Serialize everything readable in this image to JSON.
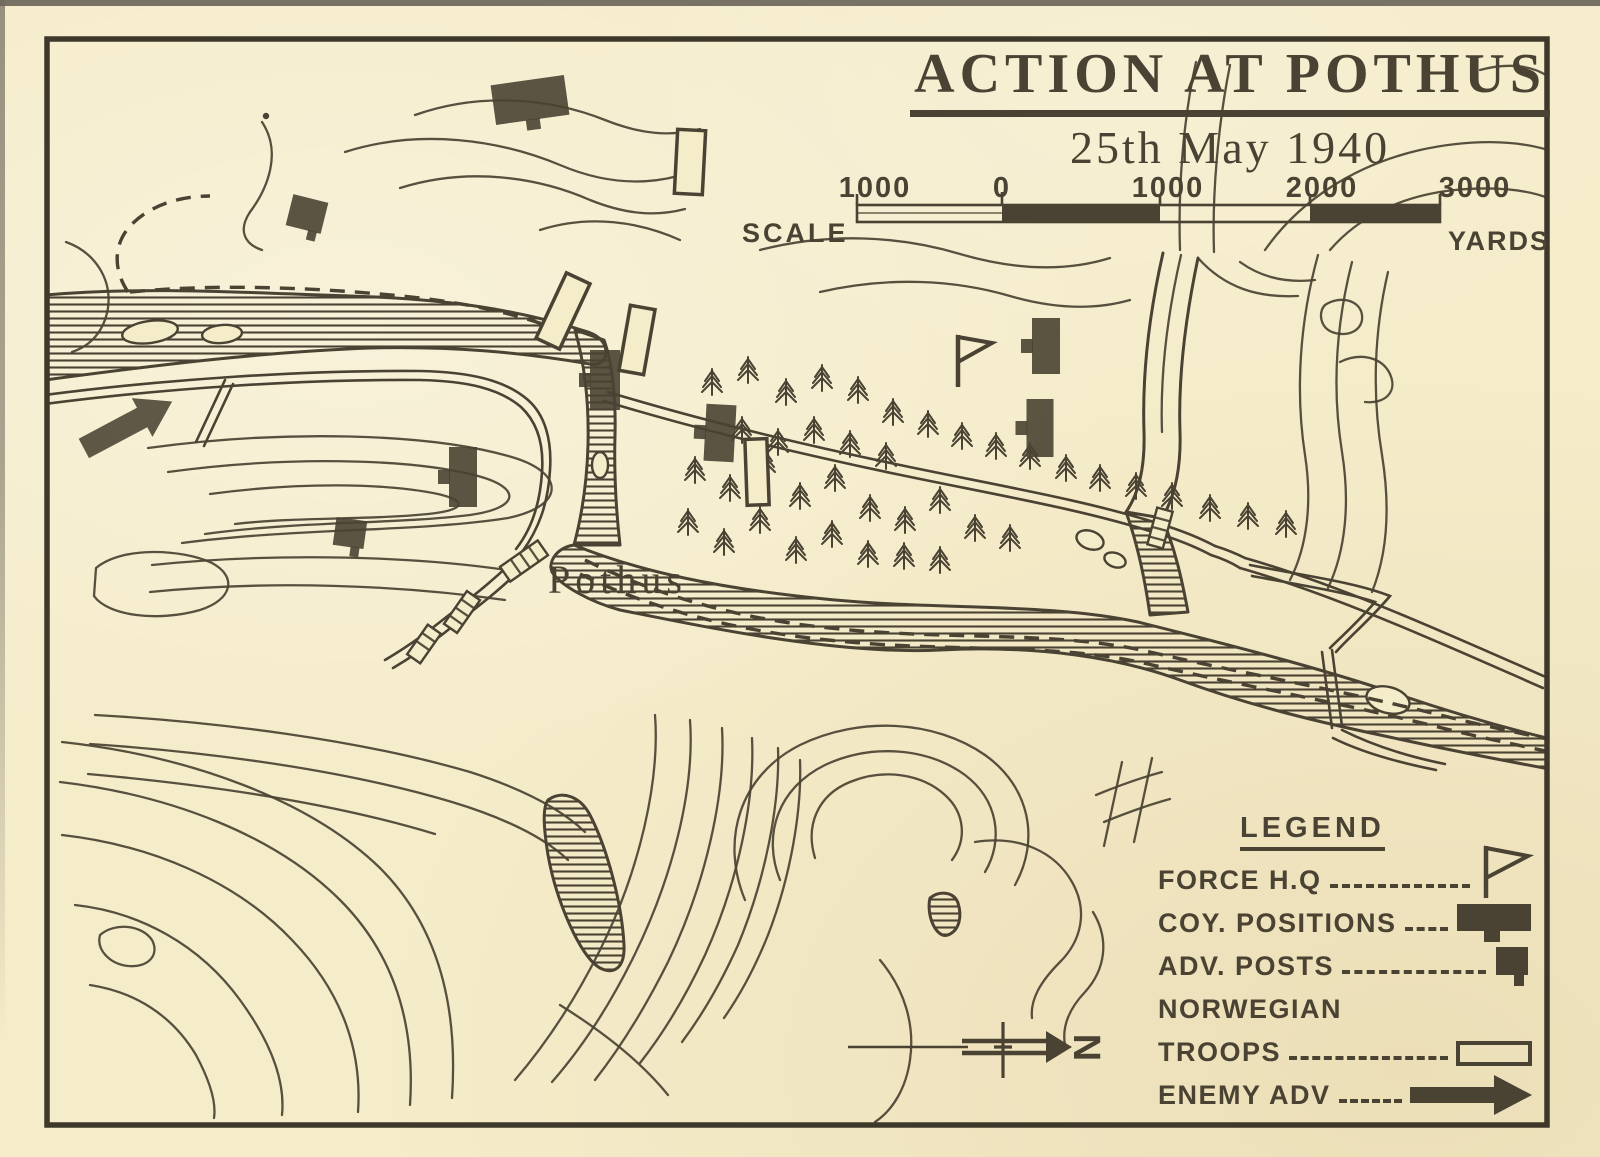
{
  "page": {
    "title": "ACTION AT POTHUS",
    "date": "25th May 1940"
  },
  "scale_bar": {
    "label": "SCALE",
    "unit": "YARDS",
    "tick_labels": [
      "1000",
      "0",
      "1000",
      "2000",
      "3000"
    ]
  },
  "map": {
    "place_label": "Pothus",
    "compass_label": "N"
  },
  "legend": {
    "heading": "LEGEND",
    "items": [
      {
        "label": "FORCE  H.Q",
        "symbol": "force-hq-flag"
      },
      {
        "label": "COY. POSITIONS",
        "symbol": "coy-position"
      },
      {
        "label": "ADV. POSTS",
        "symbol": "adv-post"
      },
      {
        "label": "NORWEGIAN",
        "label2": "TROOPS",
        "symbol": "norwegian-troops"
      },
      {
        "label": "ENEMY ADV",
        "symbol": "enemy-adv-arrow"
      }
    ]
  },
  "colors": {
    "paper": "#f5ecca",
    "ink": "#4a4232"
  },
  "markers": {
    "force_hq": {
      "x": 958,
      "y": 360
    },
    "coy_positions": [
      {
        "x": 530,
        "y": 100,
        "w": 74,
        "h": 40,
        "angle": -8,
        "tab": "bottom"
      },
      {
        "x": 463,
        "y": 477,
        "w": 28,
        "h": 60,
        "angle": 0,
        "tab": "left"
      },
      {
        "x": 605,
        "y": 380,
        "w": 30,
        "h": 60,
        "angle": 0,
        "tab": "left"
      },
      {
        "x": 720,
        "y": 433,
        "w": 30,
        "h": 57,
        "angle": 3,
        "tab": "left"
      },
      {
        "x": 1046,
        "y": 346,
        "w": 28,
        "h": 56,
        "angle": 0,
        "tab": "left"
      },
      {
        "x": 1040,
        "y": 428,
        "w": 27,
        "h": 58,
        "angle": 0,
        "tab": "left"
      }
    ],
    "adv_posts": [
      {
        "x": 307,
        "y": 214,
        "w": 36,
        "h": 32,
        "angle": 14
      },
      {
        "x": 350,
        "y": 533,
        "w": 31,
        "h": 28,
        "angle": 8
      }
    ],
    "norwegian_troops": [
      {
        "x": 563,
        "y": 311,
        "w": 26,
        "h": 72,
        "angle": 25
      },
      {
        "x": 637,
        "y": 340,
        "w": 25,
        "h": 66,
        "angle": 10
      },
      {
        "x": 690,
        "y": 162,
        "w": 28,
        "h": 64,
        "angle": 3
      },
      {
        "x": 757,
        "y": 472,
        "w": 22,
        "h": 66,
        "angle": -2
      }
    ],
    "enemy_advance": [
      {
        "x": 128,
        "y": 425,
        "length": 100,
        "angle": -28
      }
    ]
  },
  "trees": [
    [
      712,
      382
    ],
    [
      748,
      370
    ],
    [
      786,
      392
    ],
    [
      822,
      378
    ],
    [
      858,
      390
    ],
    [
      893,
      412
    ],
    [
      928,
      424
    ],
    [
      962,
      436
    ],
    [
      996,
      446
    ],
    [
      1030,
      456
    ],
    [
      1066,
      468
    ],
    [
      1100,
      478
    ],
    [
      1136,
      486
    ],
    [
      1172,
      496
    ],
    [
      1210,
      508
    ],
    [
      1248,
      516
    ],
    [
      1286,
      524
    ],
    [
      742,
      430
    ],
    [
      778,
      442
    ],
    [
      814,
      430
    ],
    [
      850,
      444
    ],
    [
      886,
      456
    ],
    [
      695,
      470
    ],
    [
      730,
      488
    ],
    [
      765,
      462
    ],
    [
      800,
      496
    ],
    [
      835,
      478
    ],
    [
      870,
      508
    ],
    [
      905,
      520
    ],
    [
      940,
      500
    ],
    [
      975,
      528
    ],
    [
      1010,
      538
    ],
    [
      688,
      522
    ],
    [
      724,
      542
    ],
    [
      760,
      520
    ],
    [
      796,
      550
    ],
    [
      832,
      534
    ],
    [
      868,
      554
    ],
    [
      904,
      556
    ],
    [
      940,
      560
    ]
  ]
}
